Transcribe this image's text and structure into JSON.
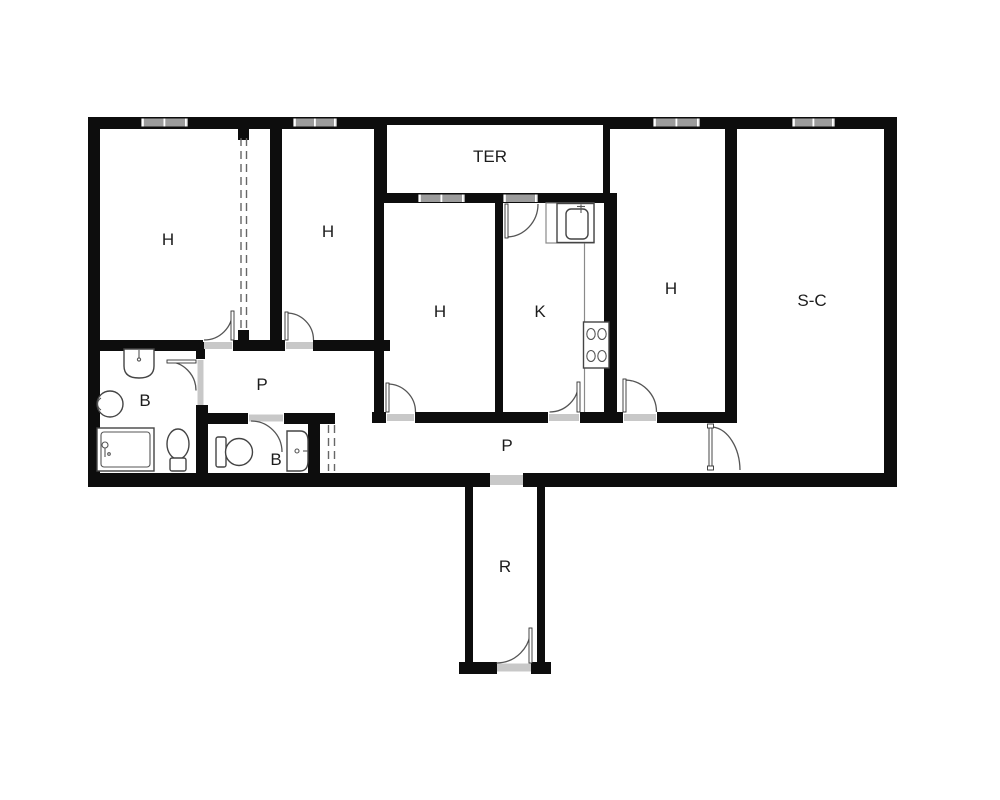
{
  "page": {
    "type": "apartment-floor-plan",
    "background": "#ffffff"
  },
  "colors": {
    "wall": "#0d0d0d",
    "window_bar": "#9c9c9c",
    "window_tick": "#ffffff",
    "door_threshold": "#c8c8c8",
    "door_arc": "#555555",
    "dashed_partition": "#666666",
    "fixture_outline": "#444444",
    "label_text": "#1c1c1c"
  },
  "rooms": {
    "h1": {
      "label": "H"
    },
    "h2": {
      "label": "H"
    },
    "h3": {
      "label": "H"
    },
    "h4": {
      "label": "H"
    },
    "k": {
      "label": "K"
    },
    "sc": {
      "label": "S-C"
    },
    "ter": {
      "label": "TER"
    },
    "p1": {
      "label": "P"
    },
    "p2": {
      "label": "P"
    },
    "b1": {
      "label": "B"
    },
    "b2": {
      "label": "B"
    },
    "r": {
      "label": "R"
    }
  }
}
